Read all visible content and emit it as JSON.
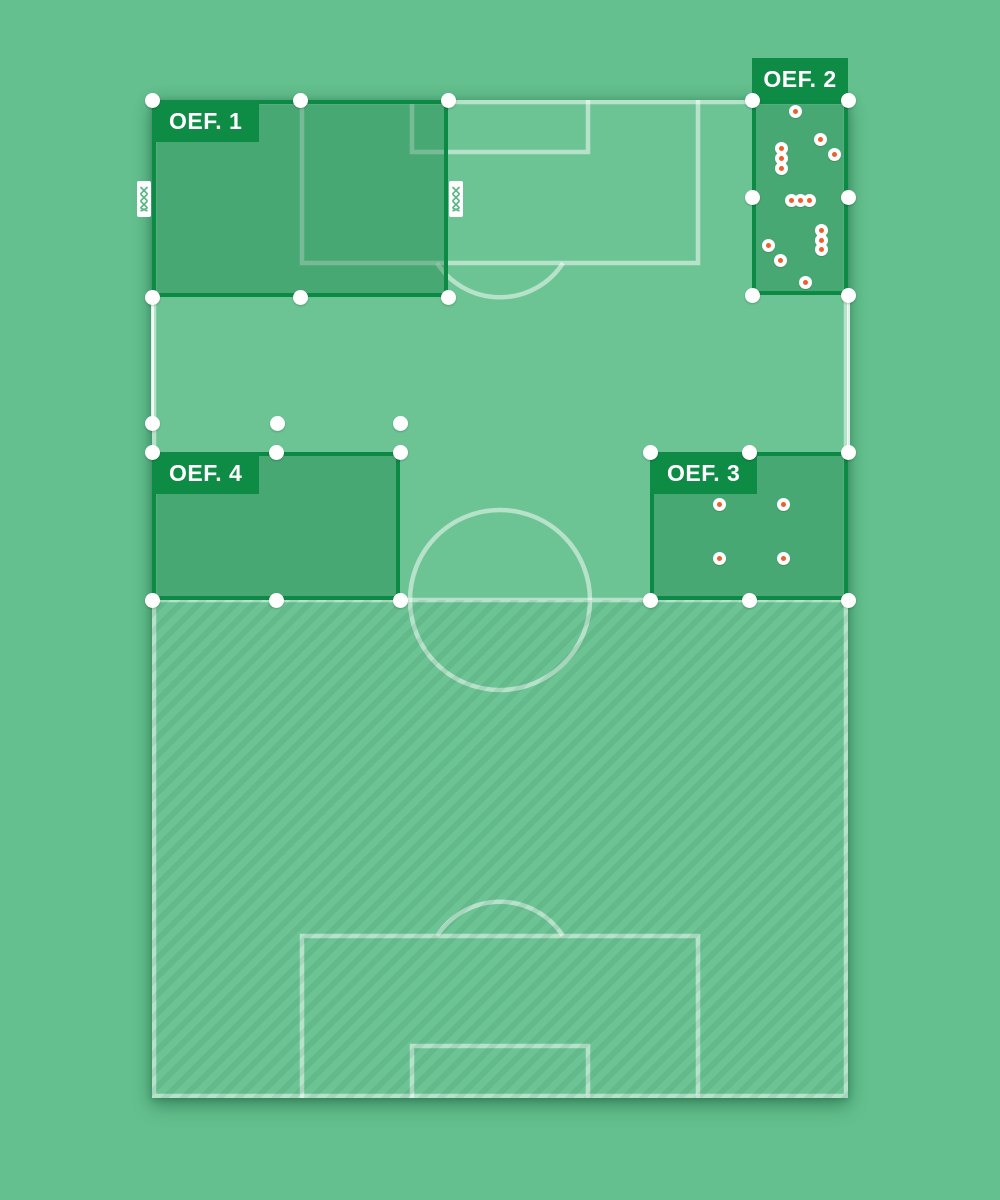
{
  "app": {
    "description_of_view": "football training pitch planner with four exercise zones on a half-hatched field"
  },
  "zones": [
    {
      "id": "oef-1",
      "label": "OEF. 1",
      "x": 152,
      "y": 100,
      "w": 296,
      "h": 197,
      "label_pos": "inside-top-left",
      "handles": [
        "tl",
        "tm",
        "tr",
        "bl",
        "bm",
        "br"
      ],
      "goals": [
        {
          "side": "left"
        },
        {
          "side": "right"
        }
      ],
      "cones": []
    },
    {
      "id": "oef-2",
      "label": "OEF. 2",
      "x": 752,
      "y": 100,
      "w": 96,
      "h": 195,
      "label_pos": "above",
      "handles": [
        "tl",
        "tr",
        "ml",
        "mr",
        "bl",
        "br"
      ],
      "goals": [],
      "cones": [
        [
          43,
          11
        ],
        [
          68,
          39
        ],
        [
          29,
          48
        ],
        [
          82,
          54
        ],
        [
          29,
          58
        ],
        [
          29,
          68
        ],
        [
          39,
          100
        ],
        [
          48,
          100
        ],
        [
          57,
          100
        ],
        [
          69,
          130
        ],
        [
          69,
          140
        ],
        [
          69,
          149
        ],
        [
          16,
          145
        ],
        [
          28,
          160
        ],
        [
          53,
          182
        ]
      ]
    },
    {
      "id": "oef-3",
      "label": "OEF. 3",
      "x": 650,
      "y": 452,
      "w": 198,
      "h": 148,
      "label_pos": "inside-top-left",
      "handles": [
        "tl",
        "tm",
        "tr",
        "bl",
        "bm",
        "br"
      ],
      "goals": [],
      "cones": [
        [
          69,
          52
        ],
        [
          133,
          52
        ],
        [
          69,
          106
        ],
        [
          133,
          106
        ]
      ]
    },
    {
      "id": "oef-4",
      "label": "OEF. 4",
      "x": 152,
      "y": 452,
      "w": 248,
      "h": 148,
      "label_pos": "inside-top-left",
      "handles": [
        "tl",
        "tm",
        "tr",
        "bl",
        "bm",
        "br"
      ],
      "goals": [],
      "cones": []
    }
  ],
  "loose_handles": [
    [
      152,
      423
    ],
    [
      277,
      423
    ],
    [
      400,
      423
    ]
  ],
  "bright_touchline_segments": [
    {
      "x": 152,
      "y1": 297,
      "y2": 423
    },
    {
      "x": 848,
      "y1": 297,
      "y2": 452
    }
  ],
  "field_geometry": {
    "x": 152,
    "y": 100,
    "w": 696,
    "h": 998,
    "hatched_half": "bottom",
    "center_line_y": 600,
    "center_circle_radius": 90
  },
  "icons": {
    "goal": "mini-goal-icon",
    "cone": "cone-marker",
    "handle": "resize-handle"
  },
  "colors": {
    "page_bg": "#64c08e",
    "field_bg": "#6cc494",
    "zone_fill": "rgba(13,124,62,0.38)",
    "zone_border": "#0c8a45",
    "label_bg": "#0e8c46",
    "label_text": "#ffffff",
    "pitch_line": "rgba(255,255,255,0.5)",
    "bright_line": "rgba(255,255,255,0.85)",
    "handle": "#ffffff",
    "cone_white": "#ffffff",
    "cone_orange": "#ef5f2b",
    "hatch_stripe": "rgba(23,92,60,0.10)"
  }
}
